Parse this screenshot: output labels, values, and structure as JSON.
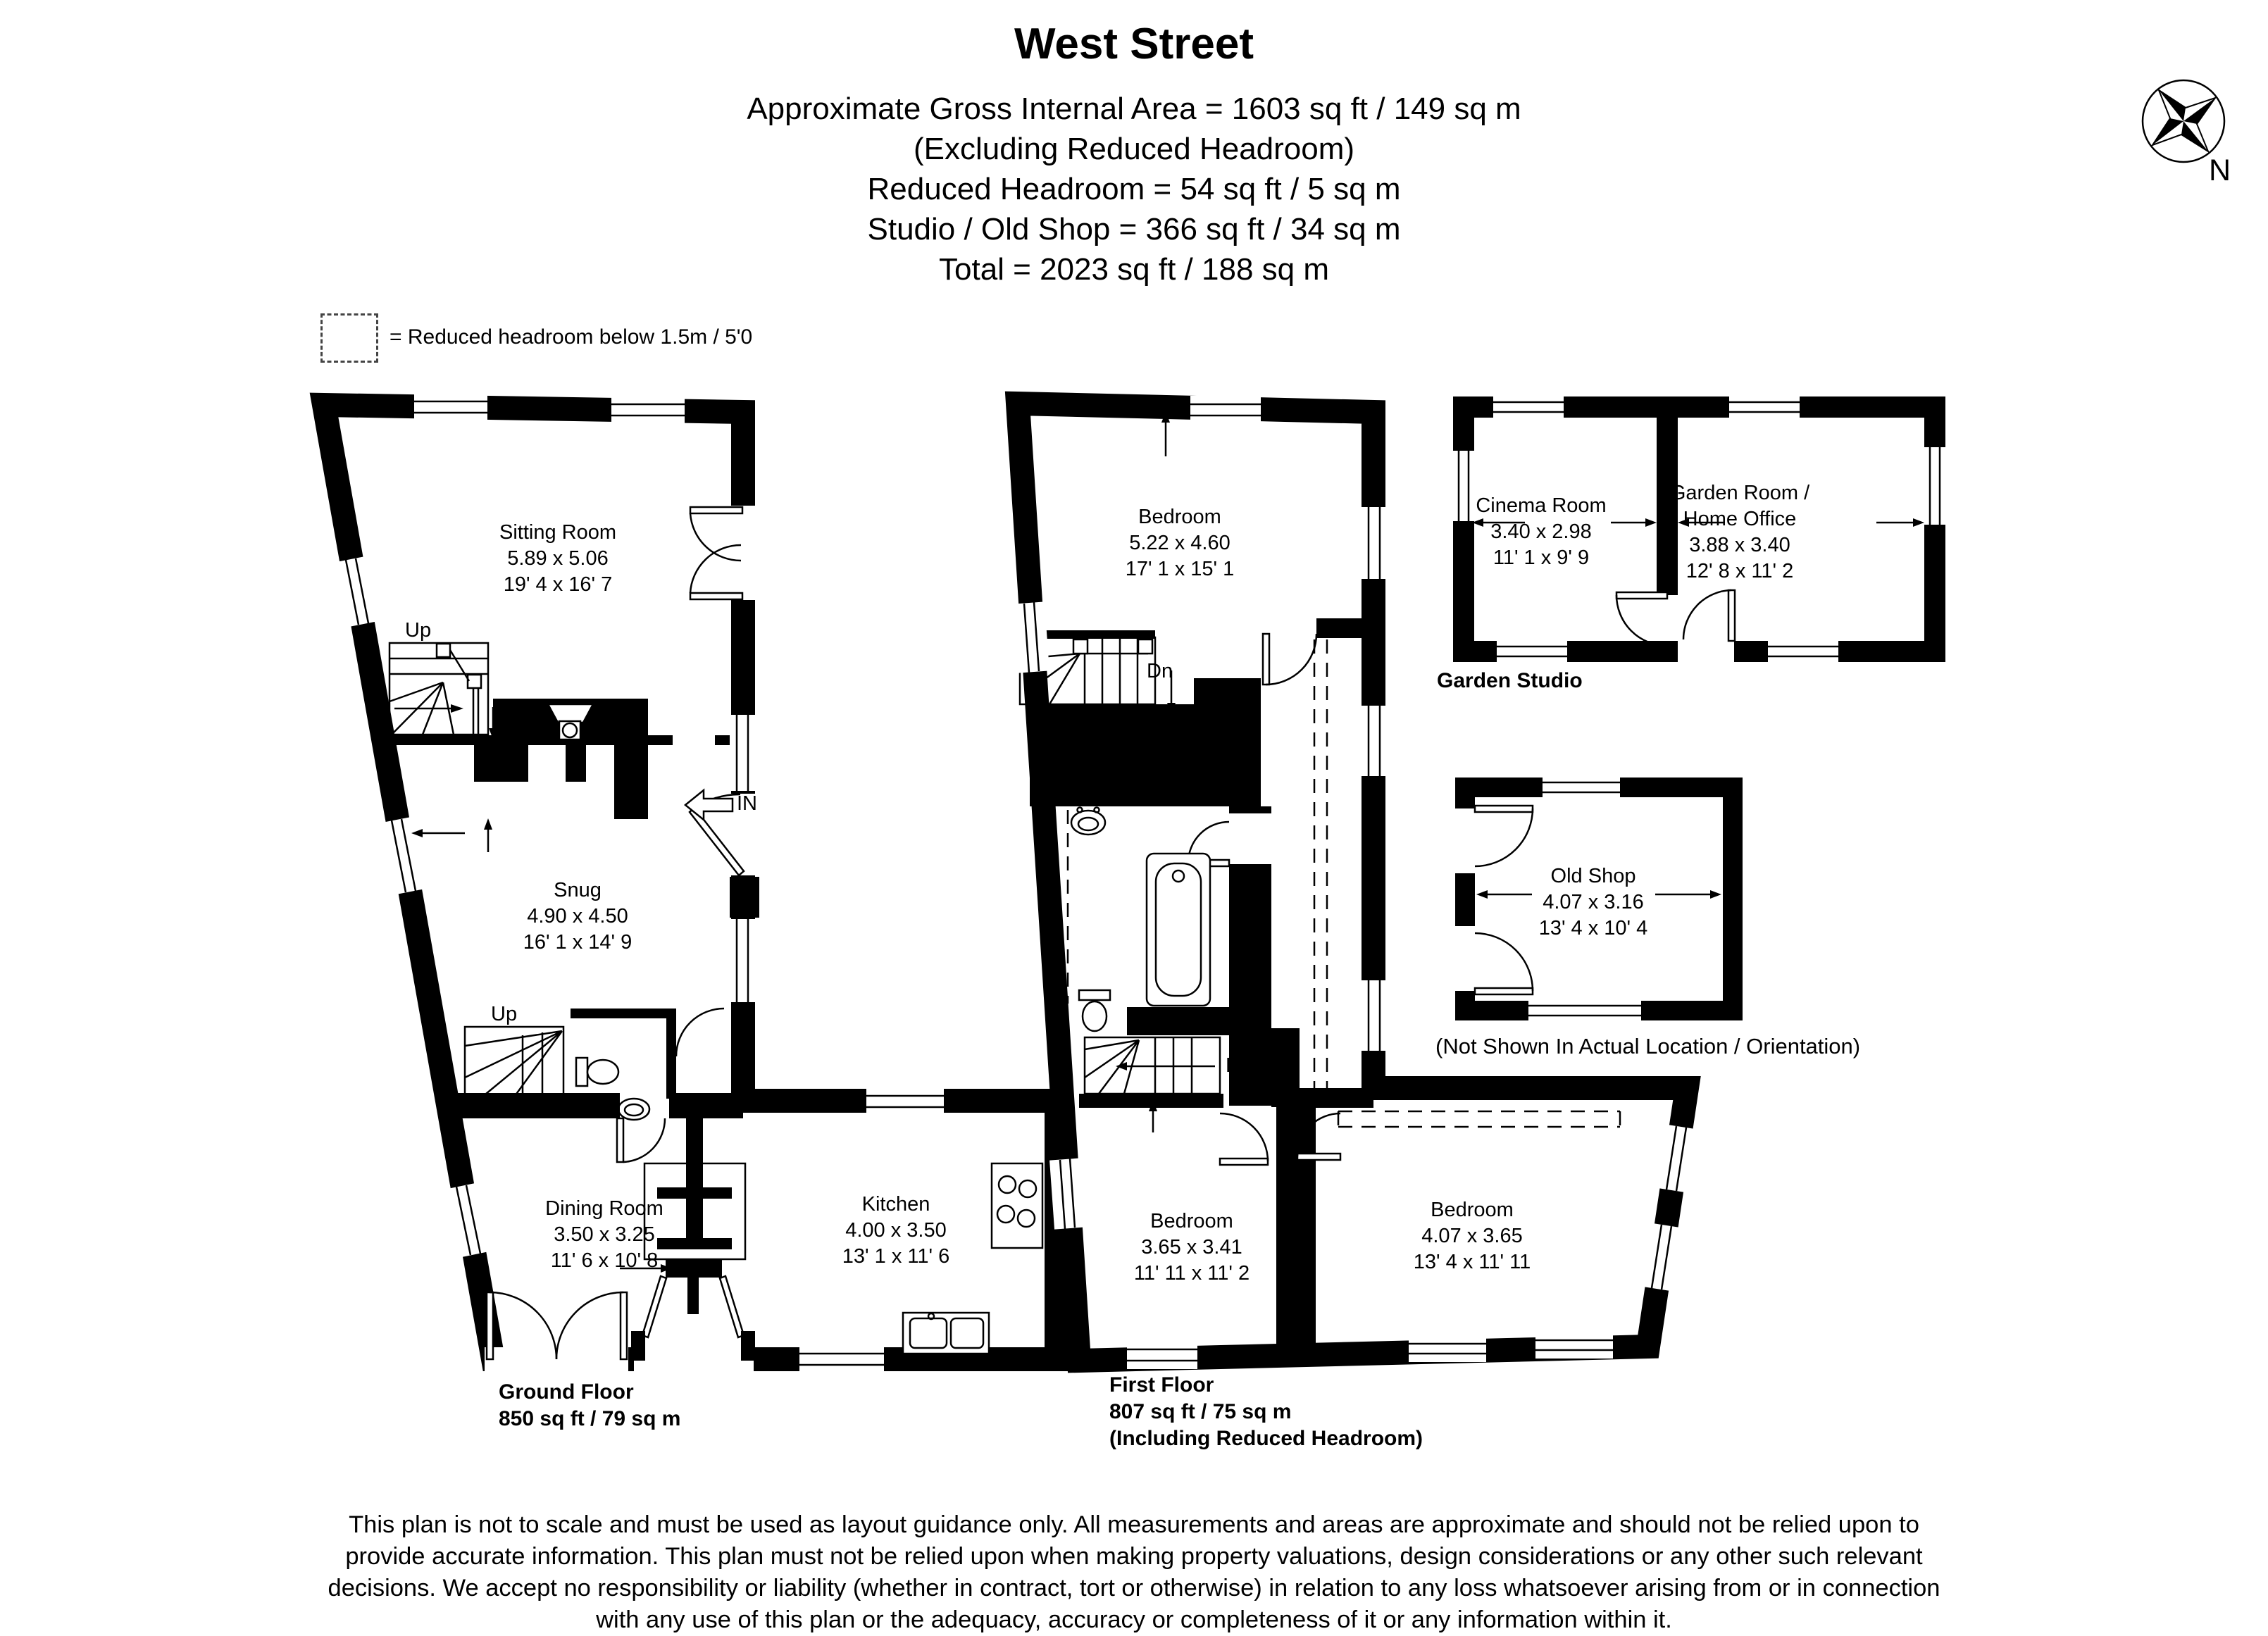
{
  "colors": {
    "wall": "#000000",
    "background": "#ffffff"
  },
  "header": {
    "title": "West Street",
    "lines": [
      "Approximate Gross Internal Area = 1603 sq ft / 149 sq m",
      "(Excluding Reduced Headroom)",
      "Reduced Headroom = 54 sq ft / 5 sq m",
      "Studio / Old Shop = 366 sq ft / 34 sq m",
      "Total = 2023 sq ft / 188 sq m"
    ]
  },
  "compass": {
    "north": "N"
  },
  "legend": {
    "text": "= Reduced headroom below 1.5m / 5'0"
  },
  "ground_floor": {
    "label": "Ground Floor",
    "area": "850 sq ft / 79 sq m",
    "rooms": {
      "sitting": {
        "name": "Sitting Room",
        "metric": "5.89 x 5.06",
        "imperial": "19' 4 x 16' 7"
      },
      "snug": {
        "name": "Snug",
        "metric": "4.90 x 4.50",
        "imperial": "16' 1 x 14' 9"
      },
      "dining": {
        "name": "Dining Room",
        "metric": "3.50 x 3.25",
        "imperial": "11' 6 x 10' 8"
      },
      "kitchen": {
        "name": "Kitchen",
        "metric": "4.00 x 3.50",
        "imperial": "13' 1 x 11' 6"
      }
    },
    "annotations": {
      "up": "Up",
      "entrance": "IN"
    }
  },
  "first_floor": {
    "label": "First Floor",
    "area": "807 sq ft / 75 sq m",
    "note": "(Including Reduced Headroom)",
    "rooms": {
      "bedroom1": {
        "name": "Bedroom",
        "metric": "5.22 x 4.60",
        "imperial": "17' 1 x 15' 1"
      },
      "bedroom2": {
        "name": "Bedroom",
        "metric": "3.65 x 3.41",
        "imperial": "11' 11 x 11' 2"
      },
      "bedroom3": {
        "name": "Bedroom",
        "metric": "4.07 x 3.65",
        "imperial": "13' 4 x 11' 11"
      }
    },
    "annotations": {
      "down": "Dn"
    }
  },
  "garden_studio": {
    "label": "Garden Studio",
    "rooms": {
      "cinema": {
        "name": "Cinema Room",
        "metric": "3.40 x 2.98",
        "imperial": "11' 1 x 9' 9"
      },
      "garden_room": {
        "name_line1": "Garden Room /",
        "name_line2": "Home Office",
        "metric": "3.88 x 3.40",
        "imperial": "12' 8 x 11' 2"
      }
    }
  },
  "old_shop": {
    "room": {
      "name": "Old Shop",
      "metric": "4.07 x 3.16",
      "imperial": "13' 4 x 10' 4"
    },
    "note": "(Not Shown In Actual Location / Orientation)"
  },
  "footer": {
    "disclaimer": "This plan is not to scale and must be used as layout guidance only. All measurements and areas are approximate and should not be relied upon to provide accurate information. This plan must not be relied upon when making property valuations, design considerations or any other such relevant decisions. We accept no responsibility or liability (whether in contract, tort or otherwise) in relation to any loss whatsoever arising from or in connection with any use of this plan or the adequacy, accuracy or completeness of it or any information within it."
  }
}
